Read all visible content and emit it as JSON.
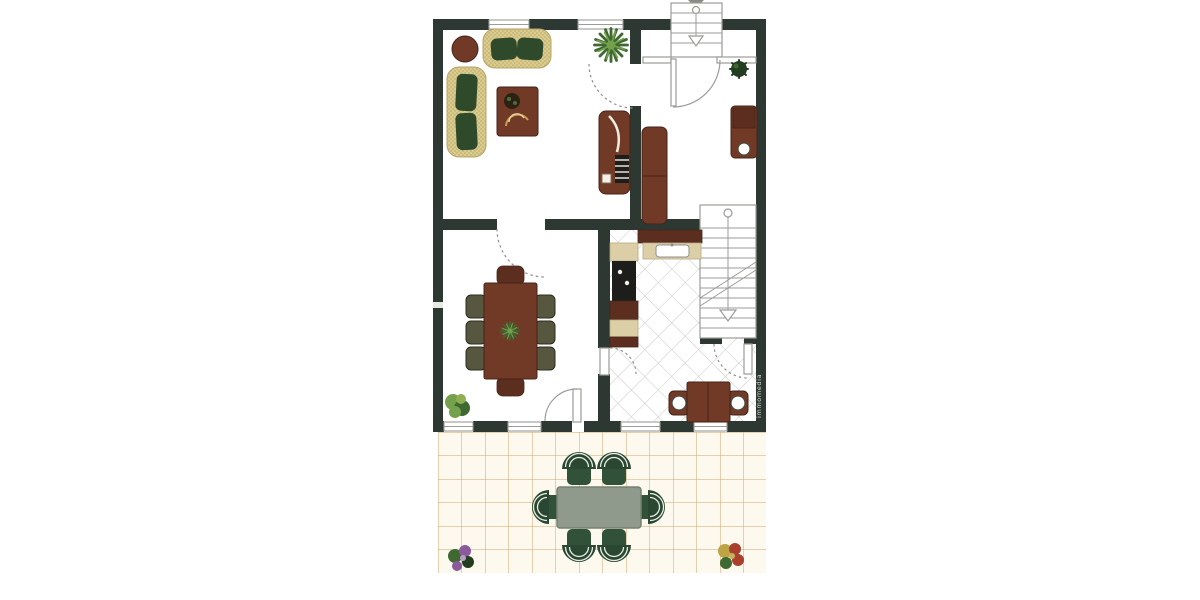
{
  "document": {
    "type": "scanned architectural floor plan",
    "floor": "ground floor with garden patio",
    "room_labels_visible": false
  },
  "watermark": {
    "text": "immomedia"
  },
  "rooms": [
    "living-room",
    "entry-hall",
    "kitchen",
    "dining-room",
    "breakfast-nook",
    "staircase",
    "patio"
  ],
  "furniture": {
    "living_room": [
      "three-seat-sofa",
      "two-seat-sofa",
      "round-side-table",
      "coffee-table",
      "decor-bowl",
      "media-sideboard",
      "potted-plant"
    ],
    "entry_hall": [
      "wardrobe",
      "desk-with-stool",
      "potted-plant",
      "entry-door",
      "exterior-entrance-stairs"
    ],
    "kitchen": [
      "sink-counter",
      "cooktop-counter",
      "interior-staircase",
      "understair-door",
      "diagonal-tile-floor"
    ],
    "breakfast_nook": [
      "square-table",
      "two-chairs"
    ],
    "dining_room": [
      "dining-table-with-8-chairs",
      "centerpiece-plant",
      "potted-plant",
      "patio-door"
    ],
    "patio": [
      "garden-table",
      "six-garden-chairs",
      "flower-pot-left",
      "flower-pot-right",
      "tile-grid-floor"
    ]
  },
  "colors": {
    "wall": "#2d3832",
    "line": "#9b9b97",
    "tile": "#c9c9c5",
    "wood": "#713a27",
    "wood2": "#5c2e1f",
    "wood_stroke": "#46231a",
    "sofa": "#dacb90",
    "cushion": "#2e4a2b",
    "beige": "#dccfa8",
    "cooktop": "#1d1d1b",
    "olive": "#57573f",
    "patio_bg": "#fdf9ee",
    "patio_line": "#cda56b",
    "patio_table": "#909a8c",
    "patio_table_stroke": "#76816f",
    "pchair": "#2a4732",
    "pchair_seat": "#315239",
    "plant1": "#76a14c",
    "plant2": "#3e6a32",
    "plant_dark": "#233d20",
    "flower_purple": "#8a5a9c",
    "flower_red": "#a8402d",
    "flower_yellow": "#bfa446"
  }
}
